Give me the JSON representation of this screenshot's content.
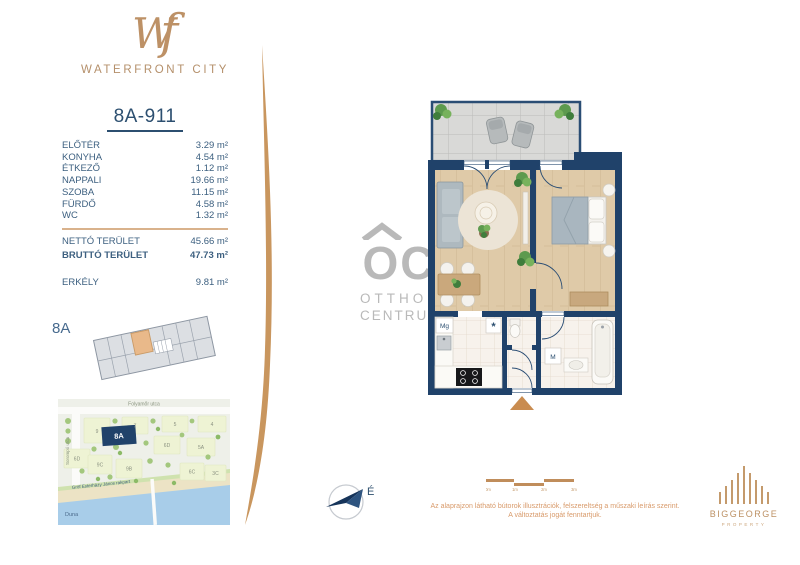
{
  "brand": {
    "monogram_w": "W",
    "monogram_f": "f",
    "name": "WATERFRONT CITY"
  },
  "unit": {
    "title": "8A-911",
    "rooms": [
      {
        "label": "ELŐTÉR",
        "area": "3.29 m²"
      },
      {
        "label": "KONYHA",
        "area": "4.54 m²"
      },
      {
        "label": "ÉTKEZŐ",
        "area": "1.12 m²"
      },
      {
        "label": "NAPPALI",
        "area": "19.66 m²"
      },
      {
        "label": "SZOBA",
        "area": "11.15 m²"
      },
      {
        "label": "FÜRDŐ",
        "area": "4.58 m²"
      },
      {
        "label": "WC",
        "area": "1.32 m²"
      }
    ],
    "totals": [
      {
        "label": "NETTÓ TERÜLET",
        "area": "45.66 m²"
      },
      {
        "label": "BRUTTÓ TERÜLET",
        "area": "47.73 m²"
      }
    ],
    "balcony": {
      "label": "ERKÉLY",
      "area": "9.81 m²"
    }
  },
  "key_plan": {
    "building": "8A"
  },
  "map": {
    "street_top": "Folyamőr utca",
    "street_left": "Sorompó utca",
    "embankment": "Gróf Esterházy János rakpart",
    "river": "Duna",
    "highlight": "8A",
    "blocks": [
      "9",
      "7",
      "5",
      "4",
      "6D",
      "5A",
      "6D",
      "9C",
      "9B",
      "6C",
      "3C"
    ]
  },
  "floorplan": {
    "washer_label": "Mg",
    "fridge_label": "*",
    "bath_label": "M"
  },
  "compass": {
    "north": "É"
  },
  "scalebar": {
    "ticks": [
      "0m",
      "1m",
      "2m",
      "3m"
    ]
  },
  "disclaimer": {
    "line1": "Az alaprajzon látható bútorok illusztrációk, felszereltség a műszaki leírás szerint.",
    "line2": "A változtatás jogát fenntartjuk."
  },
  "watermark": {
    "monogram": "OC",
    "line1": "OTTHON",
    "line2": "CENTRUM"
  },
  "developer": {
    "name": "BIGGEORGE",
    "division": "PROPERTY"
  },
  "colors": {
    "accent_tan": "#c9965e",
    "navy": "#20426a",
    "text_blue": "#3d6080",
    "watermark_gray": "#b9b9b9"
  }
}
